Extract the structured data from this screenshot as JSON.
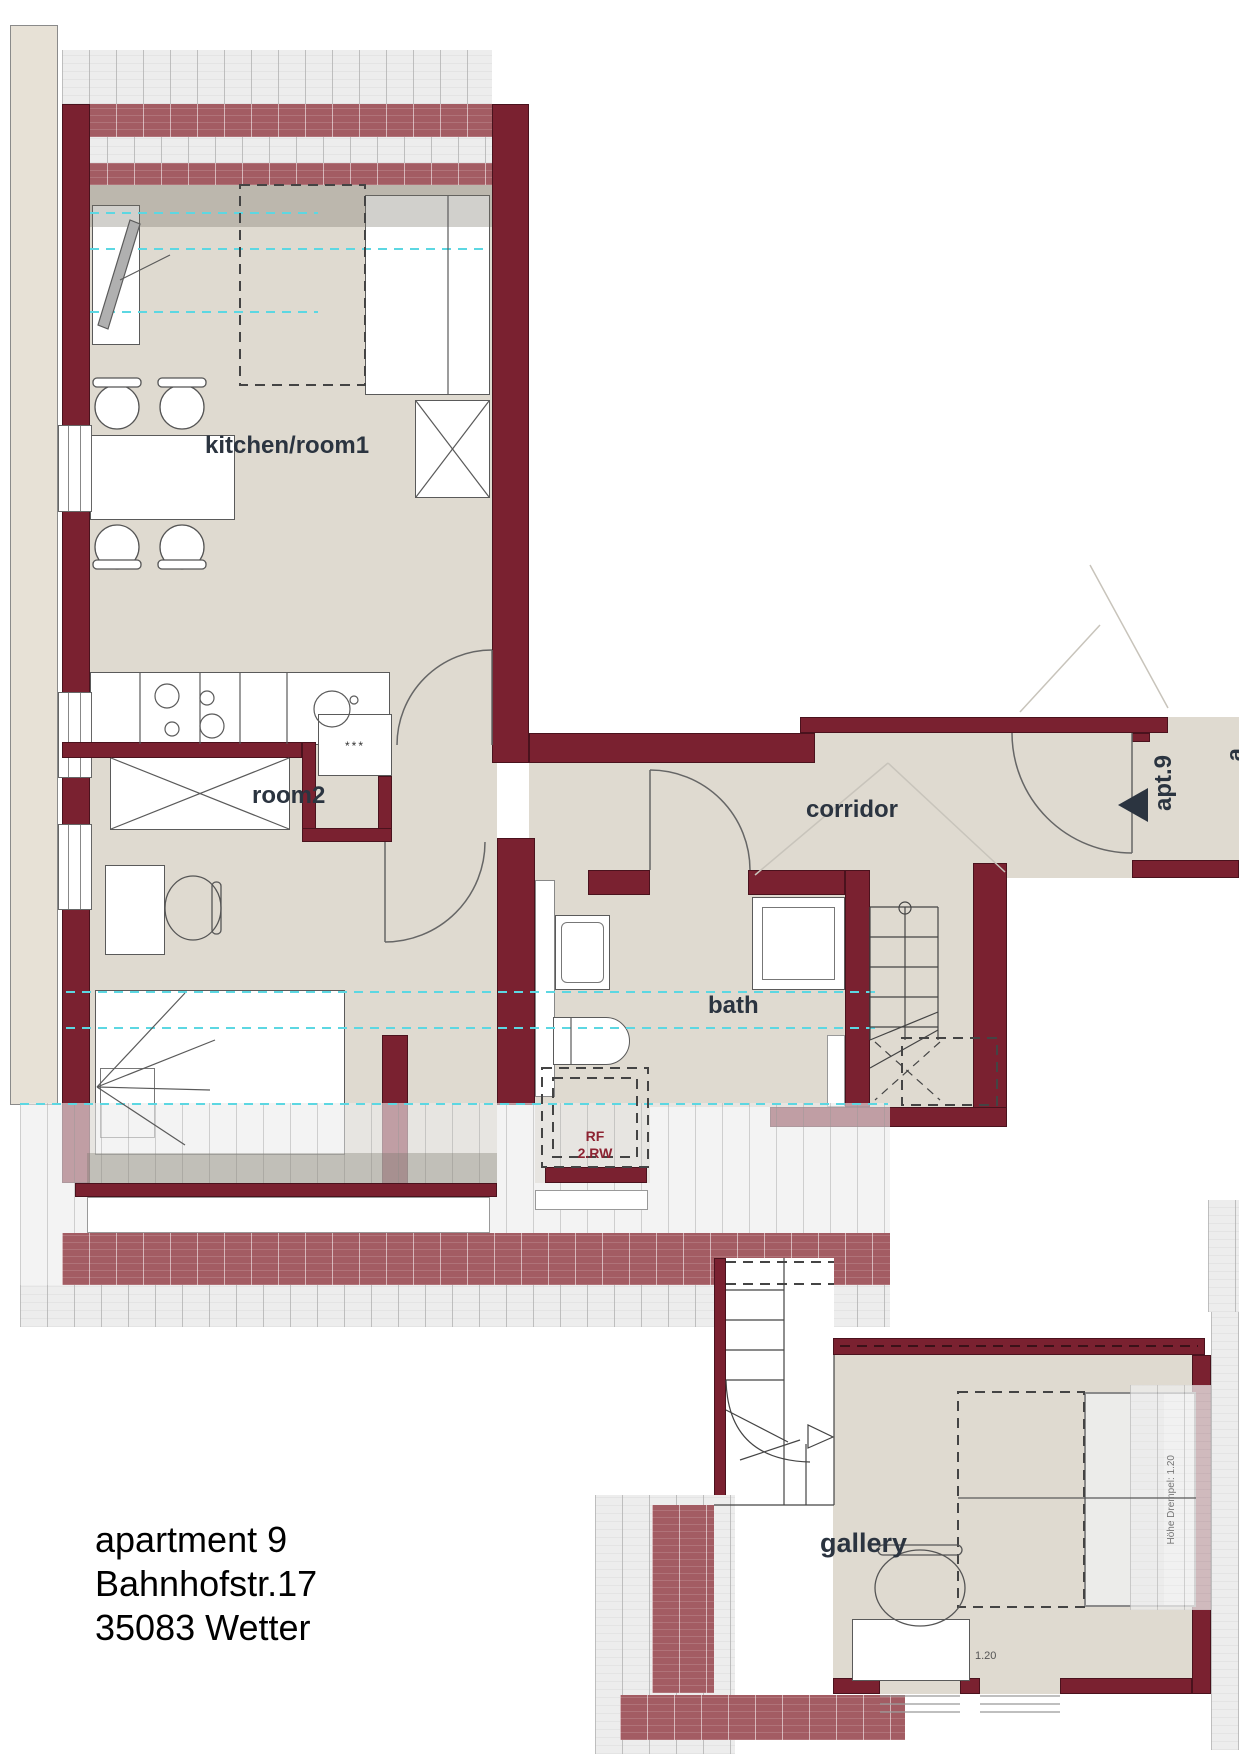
{
  "plan": {
    "address_lines": [
      "apartment 9",
      "Bahnhofstr.17",
      "35083 Wetter"
    ],
    "rooms": {
      "kitchen": "kitchen/room1",
      "room2": "room2",
      "corridor": "corridor",
      "bath": "bath",
      "gallery": "gallery"
    },
    "entrance_label": "apt.9",
    "adjacent_label_fragment": "a",
    "annotations": {
      "rf_line1": "RF",
      "rf_line2": "2.RW",
      "drempel": "Höhe Drempel: 1.20",
      "level": "1.20",
      "cabinet_marks": "***"
    },
    "colors": {
      "wall": "#7a2130",
      "wall_hatch": "#a35c63",
      "floor": "#dfdad0",
      "label": "#2b3440",
      "height_line_cyan": "#5cd7e2",
      "annotation_red": "#8d2332"
    }
  }
}
